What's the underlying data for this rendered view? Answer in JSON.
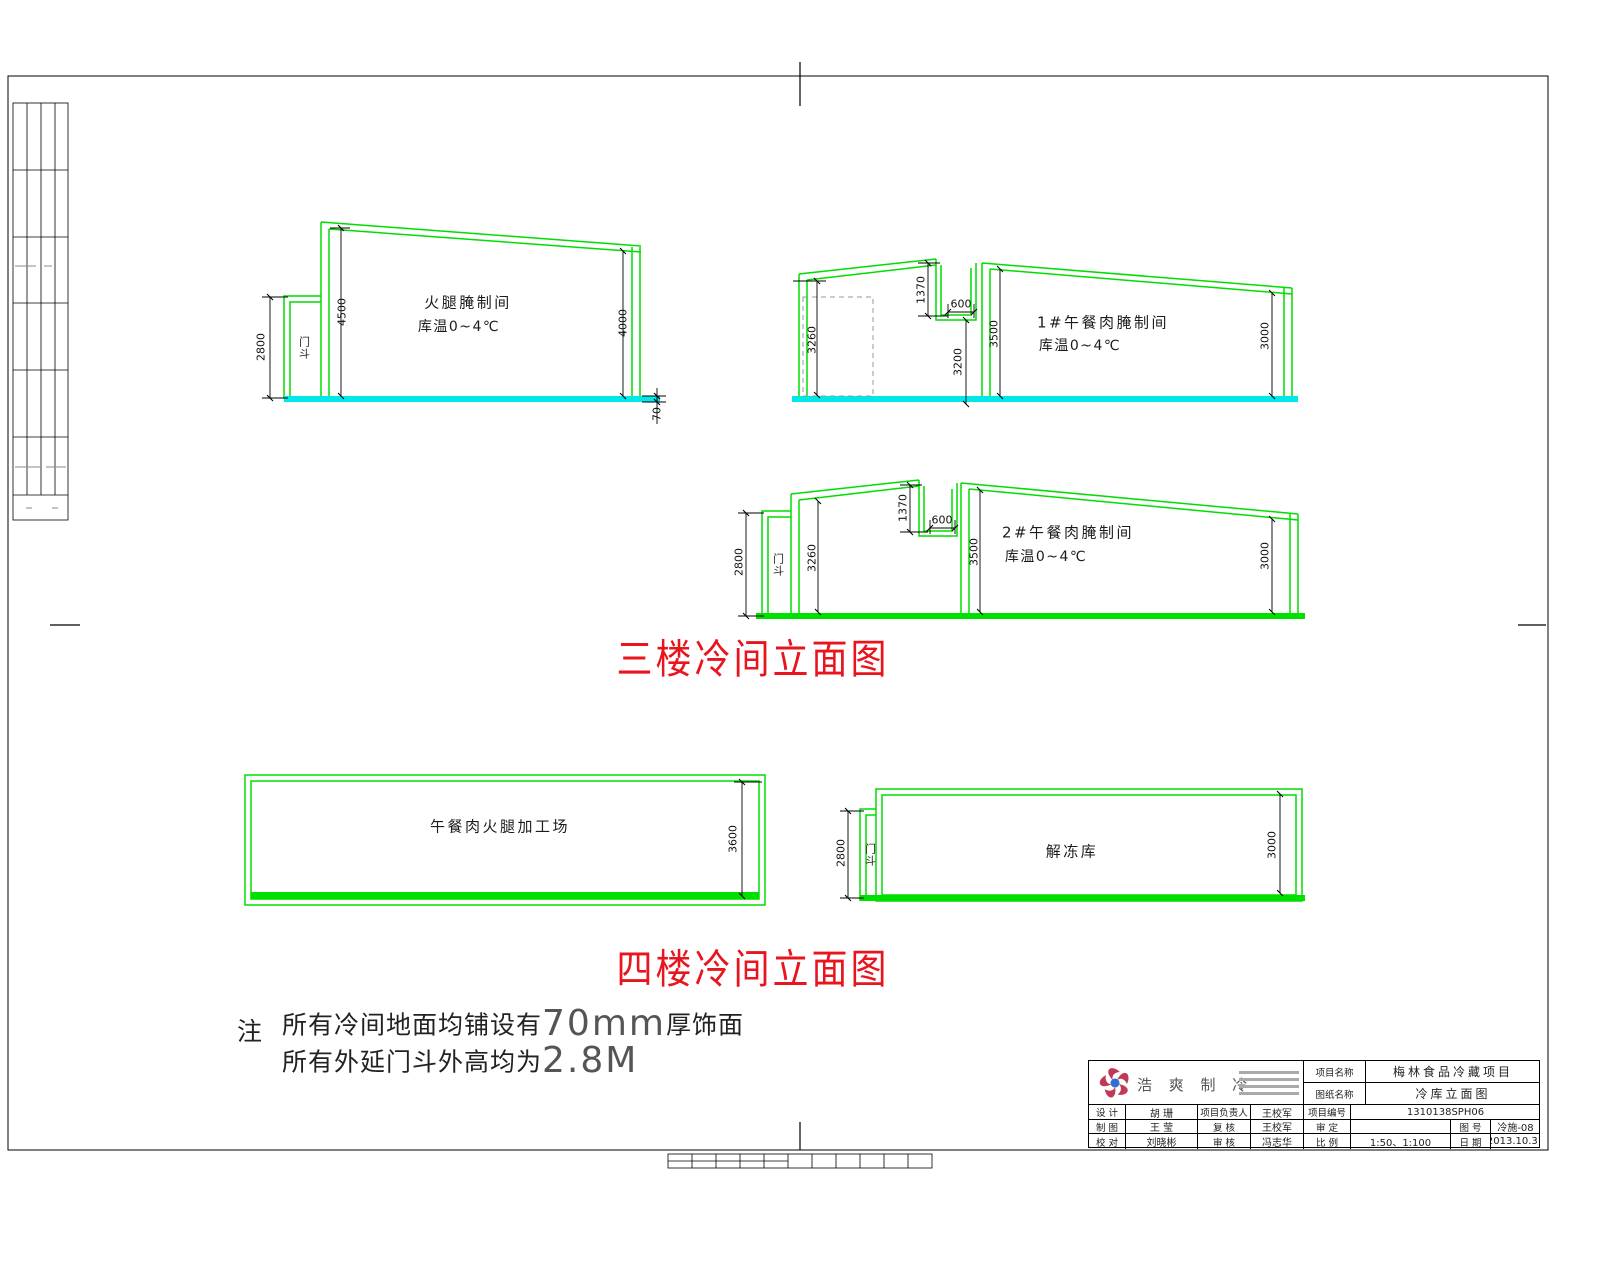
{
  "titles": {
    "floor3": "三楼冷间立面图",
    "floor4": "四楼冷间立面图"
  },
  "rooms": {
    "ham": {
      "line1": "火腿腌制间",
      "line2": "库温0~4℃"
    },
    "lunch1": {
      "line1": "1#午餐肉腌制间",
      "line2": "库温0~4℃"
    },
    "lunch2": {
      "line1": "2#午餐肉腌制间",
      "line2": "库温0~4℃"
    },
    "workshop": "午餐肉火腿加工场",
    "thaw": "解冻库",
    "vestibule": "门斗"
  },
  "dims": {
    "a2800": "2800",
    "a4500": "4500",
    "a4000": "4000",
    "a70": "70",
    "b3260": "3260",
    "b1370": "1370",
    "b600": "600",
    "b3200": "3200",
    "b3500": "3500",
    "b3000": "3000",
    "c2800": "2800",
    "c3260": "3260",
    "c1370": "1370",
    "c600": "600",
    "c3500": "3500",
    "c3000": "3000",
    "d3600": "3600",
    "e2800": "2800",
    "e3000": "3000"
  },
  "note": {
    "mark": "注",
    "l1a": "所有冷间地面均铺设有",
    "l1b": "70mm",
    "l1c": "厚饰面",
    "l2a": "所有外延门斗外高均为",
    "l2b": "2.8M"
  },
  "title_block": {
    "company": "浩 爽 制 冷",
    "project_label": "项目名称",
    "project_value": "梅林食品冷藏项目",
    "drawing_label": "图纸名称",
    "drawing_value": "冷库立面图",
    "r1c1": "设 计",
    "r1v1": "胡 珊",
    "r1c2": "项目负责人",
    "r1v2": "王校军",
    "r1c3": "项目编号",
    "r1v3": "1310138SPH06",
    "r2c1": "制 图",
    "r2v1": "王 莹",
    "r2c2": "复 核",
    "r2v2": "王校军",
    "r2c3": "审 定",
    "r2v3": "",
    "r2c4": "图 号",
    "r2v4": "冷施-08",
    "r3c1": "校 对",
    "r3v1": "刘晓彬",
    "r3c2": "审 核",
    "r3v2": "冯志华",
    "r3c3": "比 例",
    "r3v3": "1:50、1:100",
    "r3c4": "日 期",
    "r3v4": "2013.10.31"
  },
  "colors": {
    "line_green": "#00dd00",
    "floor_cyan": "#00e8e8",
    "floor_green": "#00e000",
    "title_red": "#e8141e",
    "logo_red": "#c13a55",
    "logo_blue": "#2e6fd0"
  }
}
